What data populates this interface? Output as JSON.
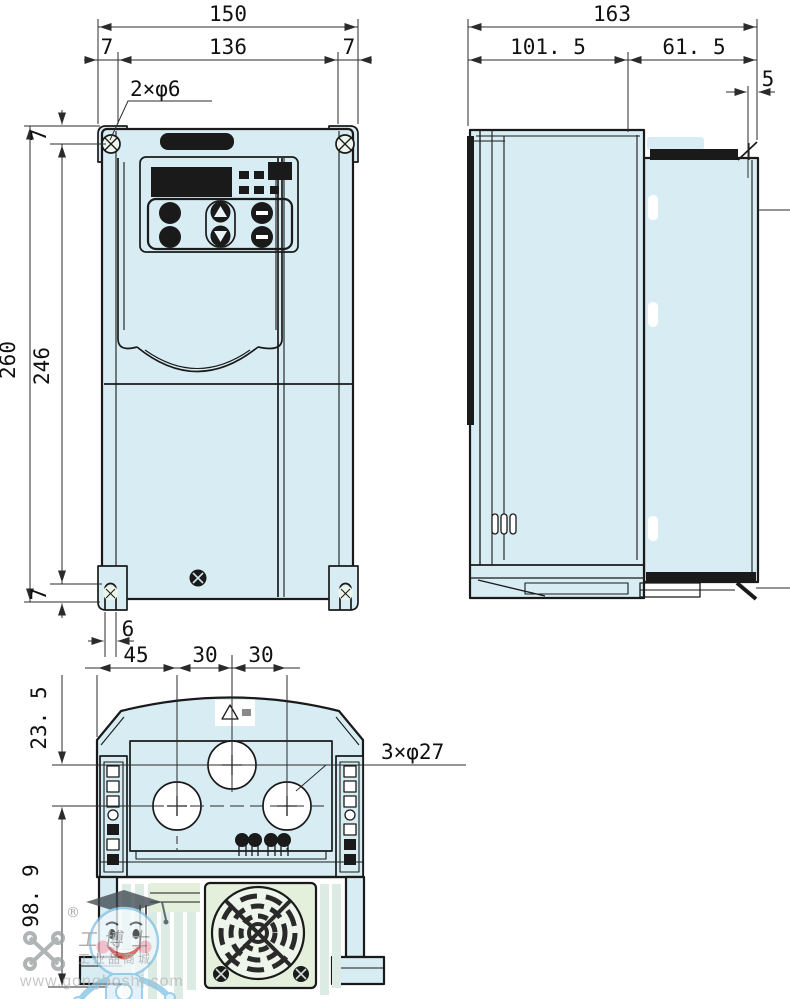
{
  "drawing_title": "inverter-outline-dimension-drawing",
  "front_view": {
    "dim_width_total": "150",
    "dim_width_inner": "136",
    "dim_margin_left": "7",
    "dim_margin_right": "7",
    "dim_height_total": "260",
    "dim_height_inner": "246",
    "dim_margin_top": "7",
    "dim_margin_bottom": "7",
    "dim_slot_width": "6",
    "mount_hole_callout": "2×φ6"
  },
  "side_view": {
    "dim_depth_total": "163",
    "dim_depth_front": "101. 5",
    "dim_depth_rear": "61. 5",
    "dim_step": "5"
  },
  "bottom_view": {
    "dim_left_offset": "45",
    "dim_hole_pitch_1": "30",
    "dim_hole_pitch_2": "30",
    "dim_row_pitch": "23. 5",
    "dim_lower_depth": "98. 9",
    "knockout_callout": "3×φ27"
  },
  "watermark": {
    "registered_mark": "®",
    "brand": "工博士",
    "tagline": "工业品商城",
    "url": "www.gongboshi.com"
  },
  "colors": {
    "body_fill": "#d7ecf3",
    "fan_plate_fill": "#e4efdc",
    "heatsink_fill": "#dcebe3",
    "outline": "#1a1a1a",
    "dimension_lines": "#2b2b2b",
    "watermark_gray": "#9a9a9a",
    "mascot_blue": "#85c4e6",
    "mascot_pink": "#f7b3c2",
    "mascot_red": "#cf4a45"
  }
}
